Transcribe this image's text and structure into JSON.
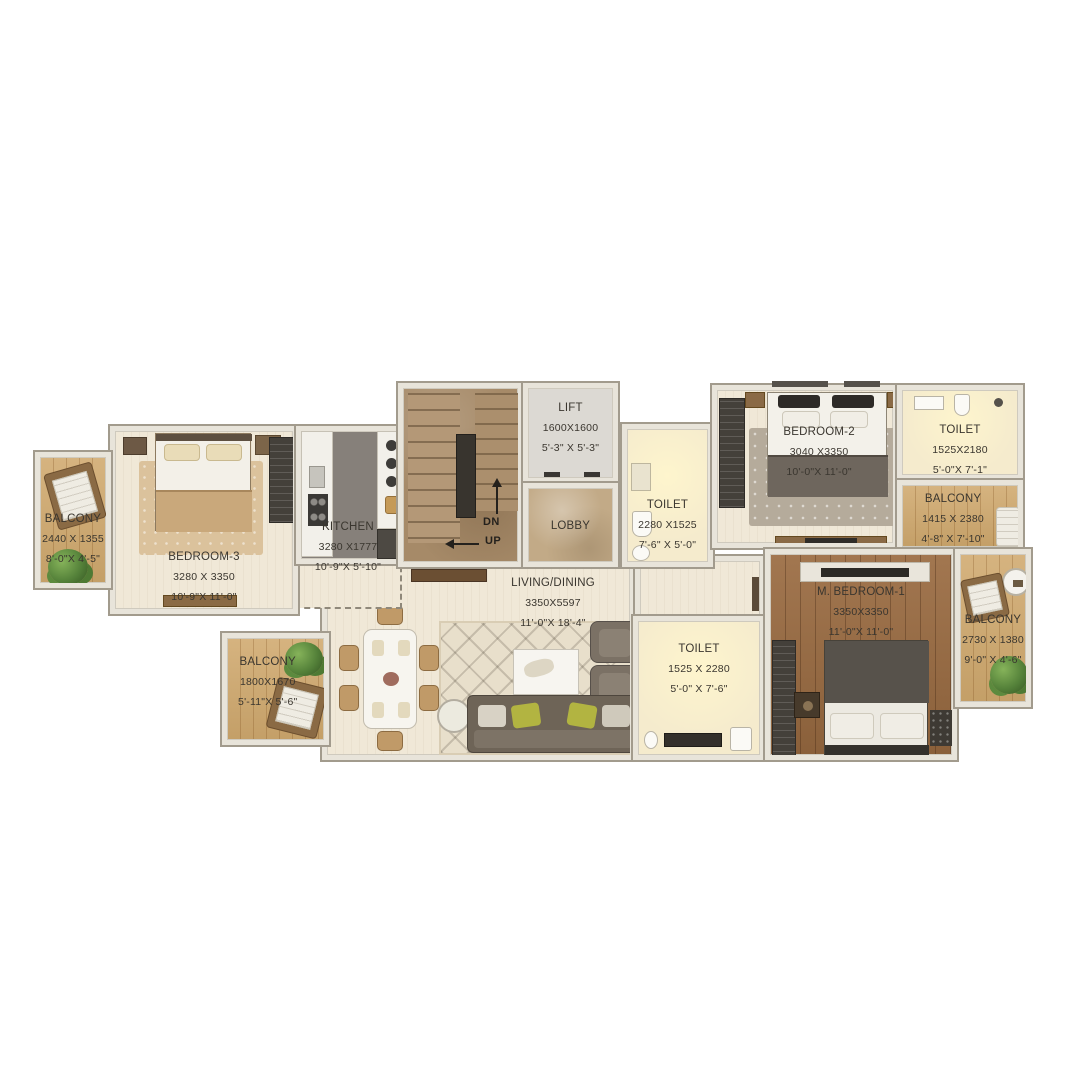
{
  "plan_title": "apartment-floor-plan",
  "colors": {
    "background": "#ffffff",
    "wall": "#e8e4da",
    "wall_edge": "#a29b8d",
    "floor_cream": "#f0e8d7",
    "floor_toilet": "#f5ebcd",
    "balcony_wood": "#d0a96e",
    "master_wood": "#9a6b41",
    "stair_stone": "#a68a68",
    "lobby_marble": "#c2aa87",
    "accent_green": "#b2b441",
    "text": "#3a362f"
  },
  "rooms": {
    "balconyLeft": {
      "name": "BALCONY",
      "mm": "2440 X 1355",
      "ft": "8'-0\"X 4'-5\""
    },
    "bedroom3": {
      "name": "BEDROOM-3",
      "mm": "3280 X 3350",
      "ft": "10'-9\"X 11'-0\""
    },
    "kitchen": {
      "name": "KITCHEN",
      "mm": "3280 X1777",
      "ft": "10'-9\"X 5'-10\""
    },
    "lift": {
      "name": "LIFT",
      "mm": "1600X1600",
      "ft": "5'-3\" X 5'-3\""
    },
    "lobby": {
      "name": "LOBBY"
    },
    "toiletCommon": {
      "name": "TOILET",
      "mm": "2280 X1525",
      "ft": "7'-6\" X 5'-0\""
    },
    "bedroom2": {
      "name": "BEDROOM-2",
      "mm": "3040 X3350",
      "ft": "10'-0\"X 11'-0\""
    },
    "toilet2": {
      "name": "TOILET",
      "mm": "1525X2180",
      "ft": "5'-0\"X 7'-1\""
    },
    "balconyRightUpper": {
      "name": "BALCONY",
      "mm": "1415 X 2380",
      "ft": "4'-8\" X 7'-10\""
    },
    "livingDining": {
      "name": "LIVING/DINING",
      "mm": "3350X5597",
      "ft": "11'-0\"X 18'-4\""
    },
    "toilet3": {
      "name": "TOILET",
      "mm": "1525 X 2280",
      "ft": "5'-0\" X 7'-6\""
    },
    "mBedroom1": {
      "name": "M. BEDROOM-1",
      "mm": "3350X3350",
      "ft": "11'-0\"X 11'-0\""
    },
    "balconyRightLower": {
      "name": "BALCONY",
      "mm": "2730 X 1380",
      "ft": "9'-0\" X 4'-6\""
    },
    "balconyDining": {
      "name": "BALCONY",
      "mm": "1800X1670",
      "ft": "5'-11\"X 5'-6\""
    }
  },
  "stairs": {
    "down_label": "DN",
    "up_label": "UP"
  }
}
